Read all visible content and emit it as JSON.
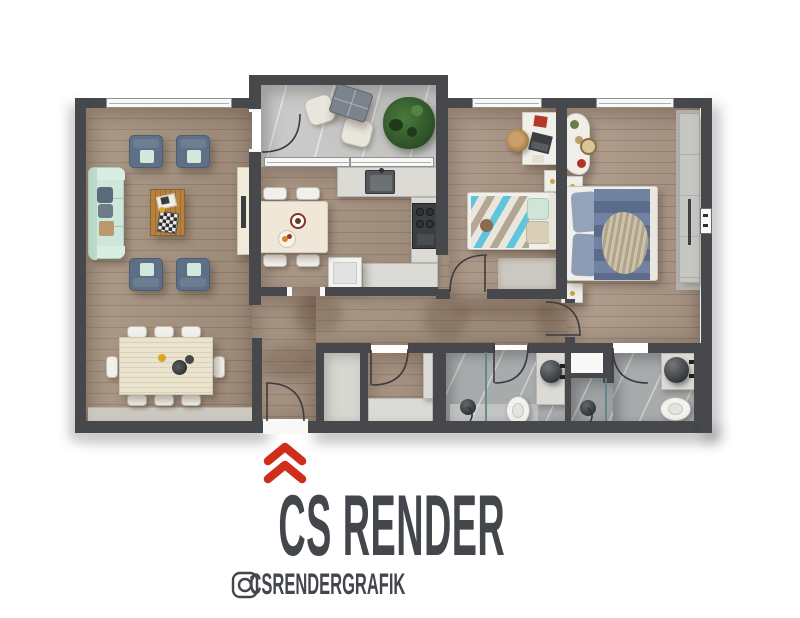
{
  "branding": {
    "studio_name": "CS RENDER",
    "instagram_handle": "CSRENDERGRAFIK",
    "accent_color": "#cf2e1b",
    "text_color": "#43464a",
    "icons": [
      "up-chevrons-icon",
      "instagram-icon"
    ]
  },
  "palette": {
    "wall": "#47484b",
    "wood_floor": "#a5917f",
    "balcony_marble": "#c9c9c8",
    "bathroom_marble": "#a8abac",
    "counter": "#dbdad5",
    "sofa_mint": "#cfe7db",
    "armchair_slate": "#5d7085",
    "bed_duvet_blue": "#64789a",
    "kids_blanket_blue": "#5fc4de",
    "coffee_table_wood": "#b5813f"
  }
}
